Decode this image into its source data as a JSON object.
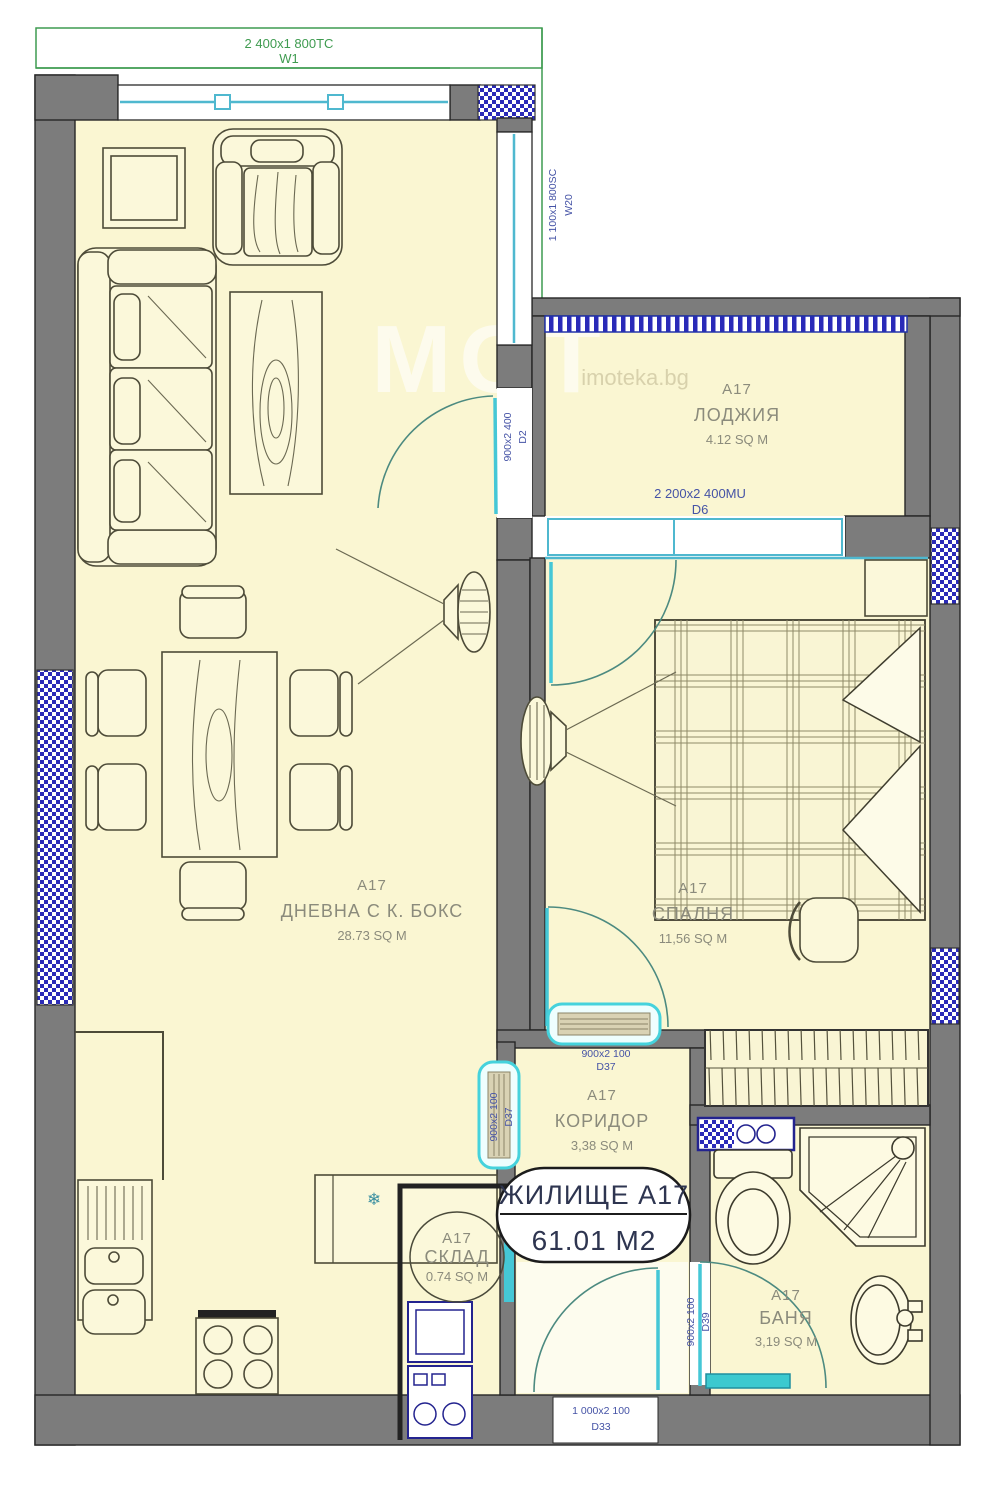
{
  "plan": {
    "windows": {
      "w1": {
        "dim": "2 400x1 800TC",
        "code": "W1"
      },
      "w20": {
        "dim": "1 100x1 800SC",
        "code": "W20"
      }
    },
    "doors": {
      "d2": {
        "dim": "900x2 400",
        "code": "D2"
      },
      "d6": {
        "dim": "2 200x2 400MU",
        "code": "D6"
      },
      "d37_bedroom": {
        "dim": "900x2 100",
        "code": "D37"
      },
      "d37_kitchen": {
        "dim": "900x2 100",
        "code": "D37"
      },
      "d39": {
        "dim": "900x2 100",
        "code": "D39"
      },
      "d33": {
        "dim": "1 000x2 100",
        "code": "D33"
      }
    },
    "rooms": {
      "living": {
        "code": "A17",
        "name": "ДНЕВНА С К. БОКС",
        "area": "28.73 SQ M"
      },
      "loggia": {
        "code": "A17",
        "name": "ЛОДЖИЯ",
        "area": "4.12 SQ M"
      },
      "bedroom": {
        "code": "A17",
        "name": "СПАЛНЯ",
        "area": "11,56 SQ M"
      },
      "corridor": {
        "code": "A17",
        "name": "КОРИДОР",
        "area": "3,38 SQ M"
      },
      "storage": {
        "code": "A17",
        "name": "СКЛАД",
        "area": "0.74 SQ M"
      },
      "bath": {
        "code": "A17",
        "name": "БАНЯ",
        "area": "3,19 SQ M"
      }
    },
    "summary": {
      "label": "ЖИЛИЩЕ А17",
      "value": "61.01 M2"
    },
    "icons": {
      "fridge_snowflake": "❄"
    },
    "watermark": {
      "big": "МОТ",
      "small": "imoteka.bg"
    },
    "colors": {
      "wall": "#7c7c7c",
      "floor": "#faf6d2",
      "window_cyan": "#4fb8cf",
      "door_teal": "#45c7d6",
      "hatch_navy": "#2a2ab8",
      "dim_navy": "#4553a6",
      "dim_green": "#3f9b50",
      "room_text": "#8b8b7c"
    }
  }
}
